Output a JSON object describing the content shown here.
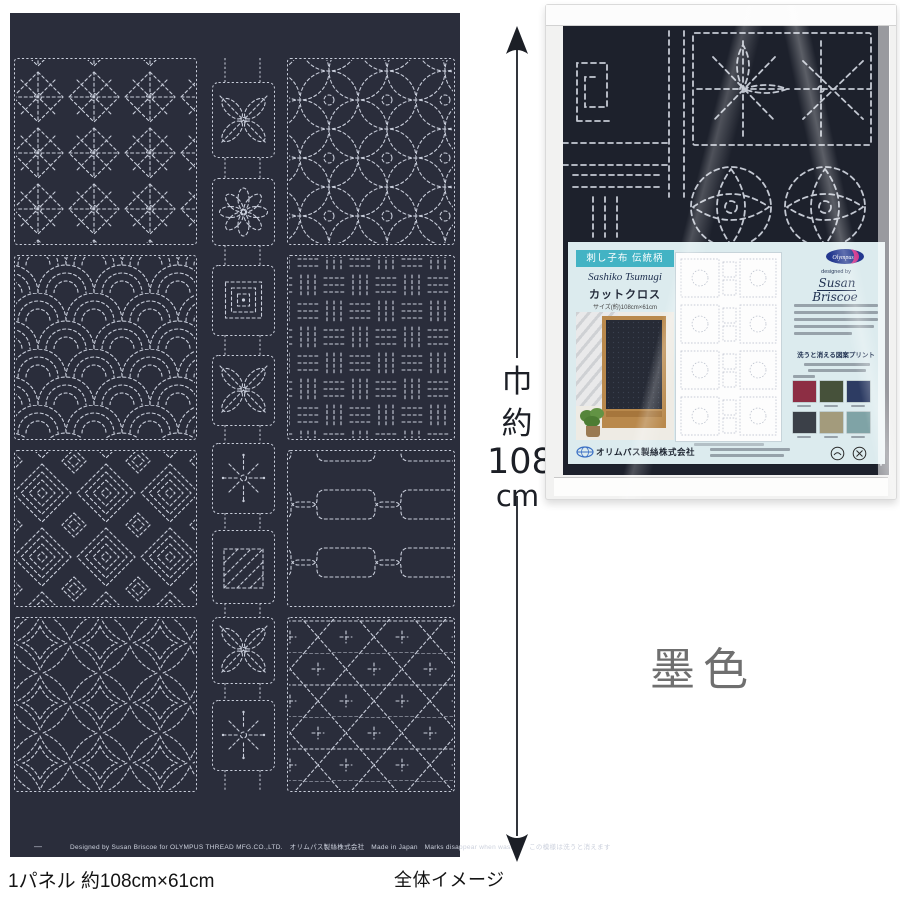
{
  "measure": {
    "width_char": "巾",
    "approx_char": "約",
    "value": "108",
    "unit": "cm"
  },
  "color_label": "墨色",
  "caption": {
    "panel_size": "1パネル 約108cm×61cm",
    "overall": "全体イメージ"
  },
  "selvage": {
    "dash": "—",
    "text": "Designed by Susan Briscoe for OLYMPUS THREAD MFG.CO.,LTD.　オリムパス製絲株式会社　Made in Japan　Marks disappear when washed　この模様は洗うと消えます"
  },
  "package": {
    "banner": "刺し子布 伝統柄",
    "title_en": "Sashiko Tsumugi",
    "title_jp": "カットクロス",
    "size_note": "サイズ(約)108cm×61cm",
    "brand": "Olympus",
    "designed_by": "designed by",
    "designer": "Susan Briscoe",
    "wash_note": "洗うと消える図案プリント",
    "company": "オリムパス製絲株式会社",
    "swatches": [
      {
        "name": "wine",
        "hex": "#8d2e44"
      },
      {
        "name": "olive-green",
        "hex": "#46513a"
      },
      {
        "name": "navy",
        "hex": "#2d3c63"
      },
      {
        "name": "charcoal",
        "hex": "#3b4048"
      },
      {
        "name": "khaki",
        "hex": "#a39b7c"
      },
      {
        "name": "teal-gray",
        "hex": "#7fa3a6"
      }
    ]
  }
}
